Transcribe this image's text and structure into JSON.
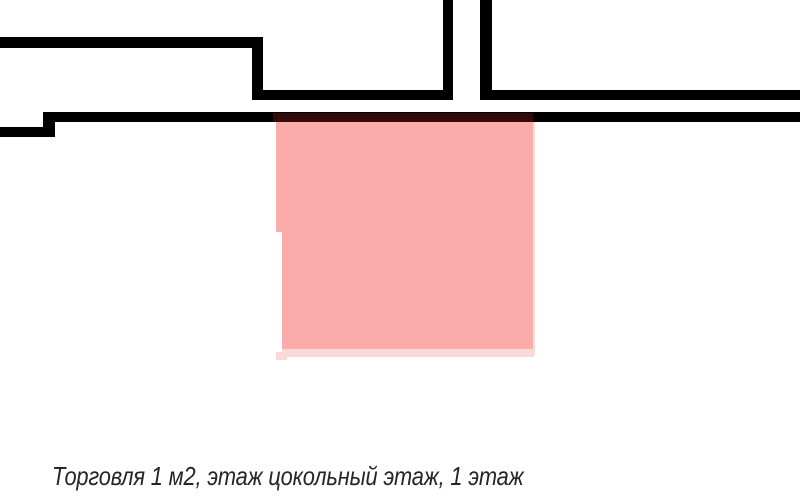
{
  "caption": {
    "text": "Торговля 1 м2, этаж цокольный этаж, 1 этаж"
  },
  "colors": {
    "background": "#ffffff",
    "wall": "#000000",
    "highlight_fill": "#fcabab",
    "highlight_border": "#fcd9d9",
    "highlight_overlap": "#330909",
    "caption_text": "#262626"
  }
}
